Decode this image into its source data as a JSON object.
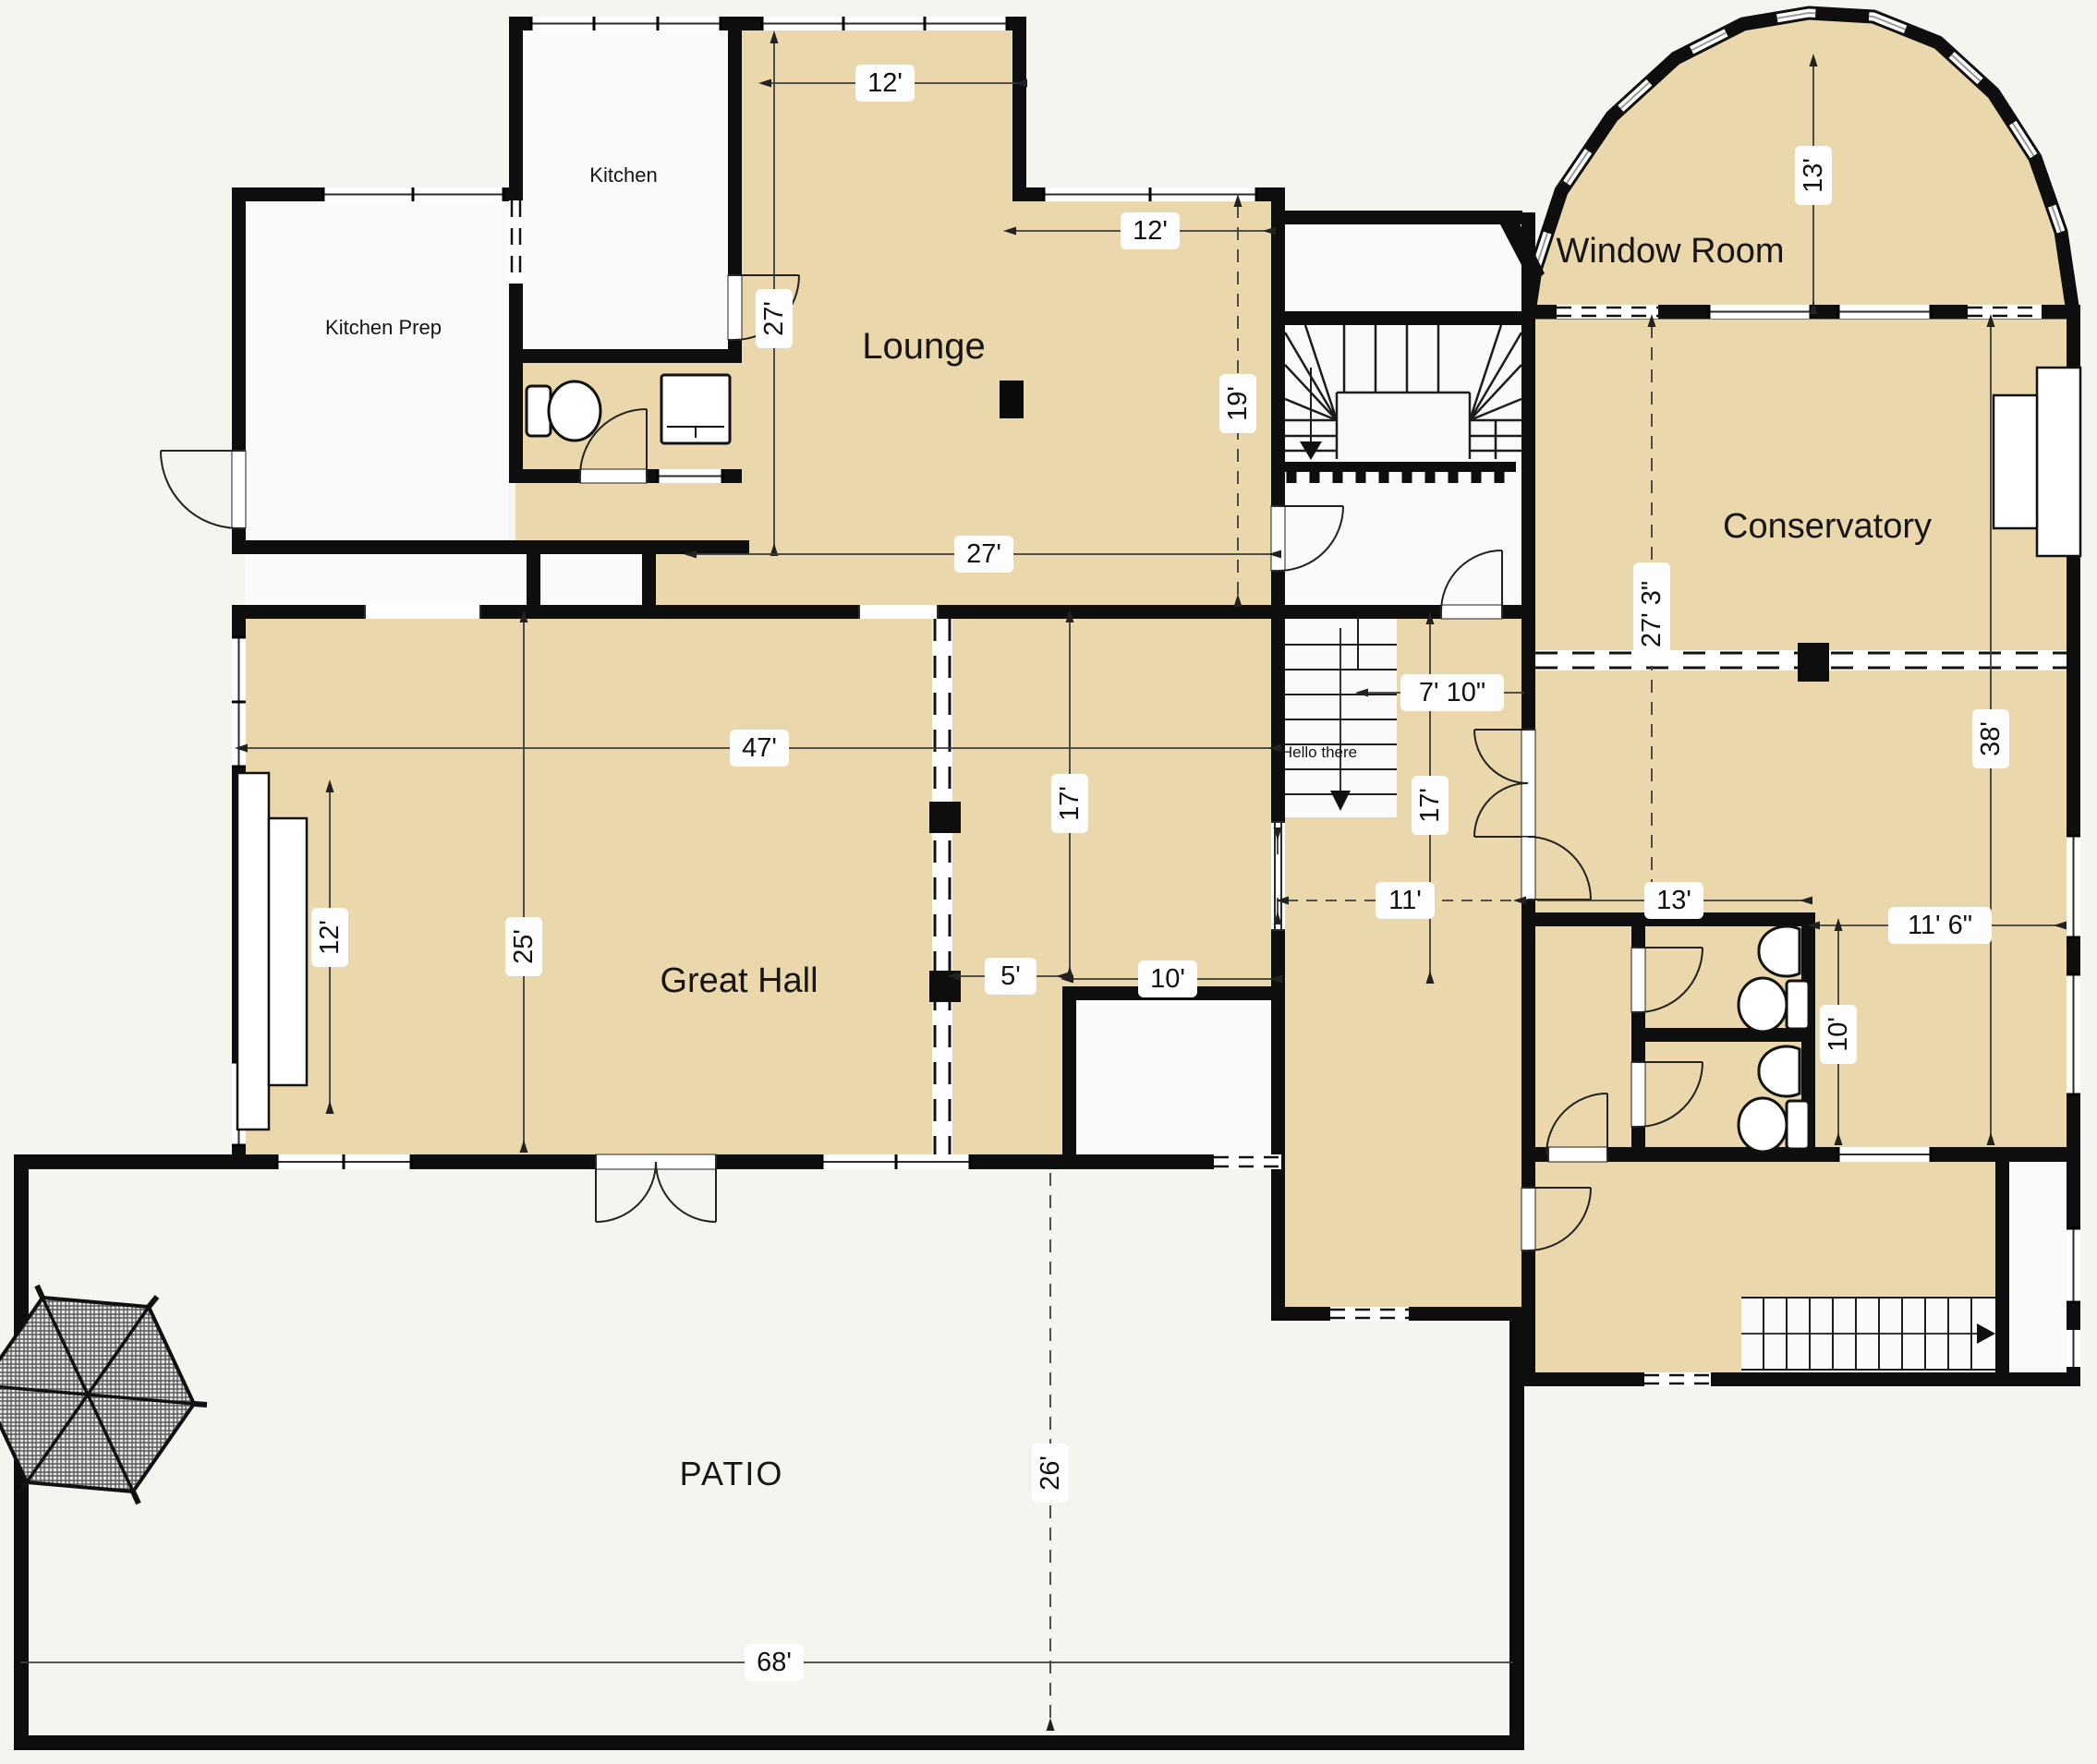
{
  "plan_title": "Ground floor plan",
  "colors": {
    "background": "#f6f4ef",
    "floor_fill": "#ead7ab",
    "wall": "#0e0e0e",
    "dim_line": "#3c3c3c",
    "label_background": "#fdfdfd"
  },
  "rooms": {
    "kitchen": "Kitchen",
    "kitchen_prep": "Kitchen Prep",
    "lounge": "Lounge",
    "window_room": "Window Room",
    "conservatory": "Conservatory",
    "great_hall": "Great Hall",
    "patio": "PATIO",
    "stair_note": "Hello there"
  },
  "dimensions": {
    "lounge_top_width": "12'",
    "lounge_upper_right_width": "12'",
    "lounge_left_height": "27'",
    "lounge_right_height": "19'",
    "lounge_width": "27'",
    "window_room_depth": "13'",
    "conservatory_upper_height": "27' 3\"",
    "conservatory_height": "38'",
    "great_hall_width": "47'",
    "stair_landing_width": "7' 10\"",
    "inner_hall_height": "17'",
    "great_hall_right_height": "17'",
    "corridor_width": "11'",
    "lobby_width": "13'",
    "lobby_right_width": "11' 6\"",
    "washroom_height": "10'",
    "fireplace_span": "12'",
    "great_hall_depth": "25'",
    "nook_width": "5'",
    "nook_right_width": "10'",
    "patio_depth": "26'",
    "patio_width": "68'"
  }
}
